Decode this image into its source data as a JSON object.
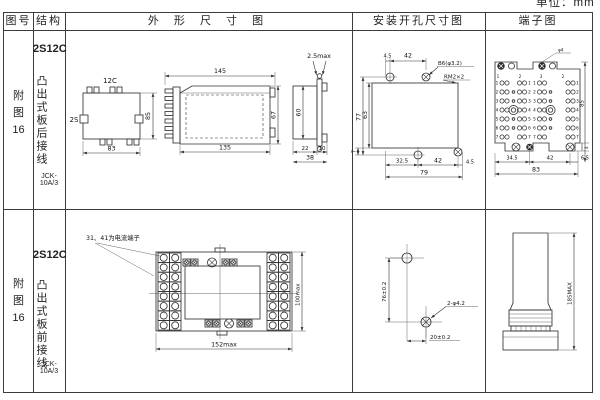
{
  "unit_note": "单位：mm",
  "header": {
    "fig_no": "图号",
    "structure": "结构",
    "outline": "外 形 尺 寸 图",
    "mounting": "安装开孔尺寸图",
    "terminal": "端子图"
  },
  "row1": {
    "fig": {
      "c1": "附",
      "c2": "图",
      "c3": "16"
    },
    "structure": {
      "model": "2S12C",
      "wiring": "凸出式板后接线",
      "product": "JCK-10A/3"
    },
    "outline": {
      "back": {
        "top": "12C",
        "left": "2S",
        "height": "85",
        "width": "83"
      },
      "side": {
        "top": "145",
        "bottom": "135",
        "height": "67"
      },
      "end": {
        "thickness": "2.5max",
        "height": "60",
        "d22": "22",
        "d10": "10",
        "d38": "38"
      }
    },
    "mounting": {
      "top_offset": "4.5",
      "top_pitch": "42",
      "hole_callout": "B6(φ3.2)",
      "screw_callout": "RM2×2",
      "height_outer": "77",
      "height_inner": "63",
      "bottom_offset": "7",
      "b1": "32.5",
      "b2": "42",
      "b3": "4.5",
      "total": "79"
    },
    "terminal": {
      "screw_marks": [
        "1",
        "2",
        "3",
        "2"
      ],
      "row_nums": [
        "1",
        "2",
        "3",
        "4",
        "5",
        "6",
        "7"
      ],
      "callout": "φ4",
      "b1": "34.5",
      "b2": "42",
      "b3": "6.5",
      "total": "83",
      "height": "85",
      "foot": "4"
    }
  },
  "row2": {
    "fig": {
      "c1": "附",
      "c2": "图",
      "c3": "16"
    },
    "structure": {
      "model": "2S12C",
      "wiring": "凸出式板前接线",
      "product": "JCK-10A/3"
    },
    "outline": {
      "note": "31、41为电流端子",
      "width": "152max",
      "height": "100max"
    },
    "mounting": {
      "vertical": "76±0.2",
      "horizontal": "20±0.2",
      "callout": "2-φ4.2"
    },
    "terminal": {
      "height": "185MAX"
    }
  }
}
